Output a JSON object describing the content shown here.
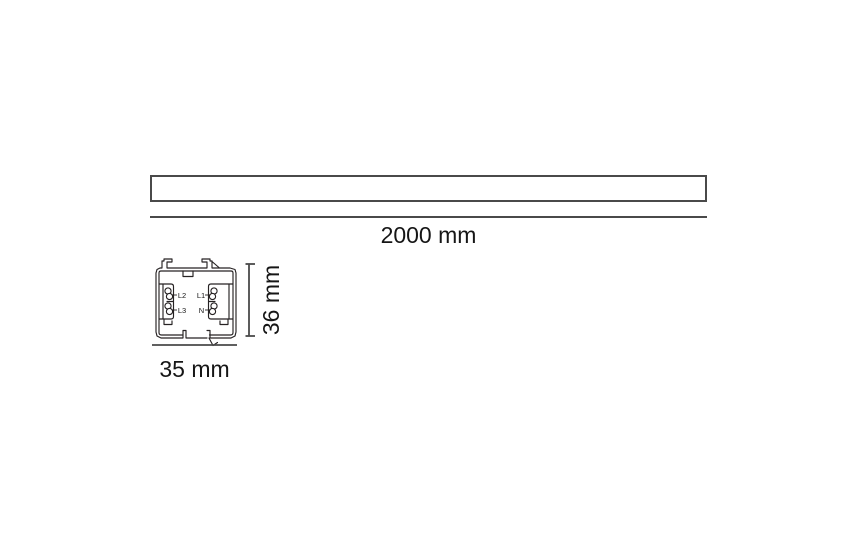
{
  "top_view": {
    "length_label": "2000 mm"
  },
  "cross_section": {
    "width_label": "35 mm",
    "height_label": "36 mm",
    "conductors": [
      {
        "id": "L2",
        "position": "upper-left"
      },
      {
        "id": "L1",
        "position": "upper-right"
      },
      {
        "id": "L3",
        "position": "lower-left"
      },
      {
        "id": "N",
        "position": "lower-right"
      }
    ]
  },
  "colors": {
    "background": "#ffffff",
    "profile_outline": "#262223",
    "dimension_line": "#4a4a4a",
    "text": "#161616"
  }
}
